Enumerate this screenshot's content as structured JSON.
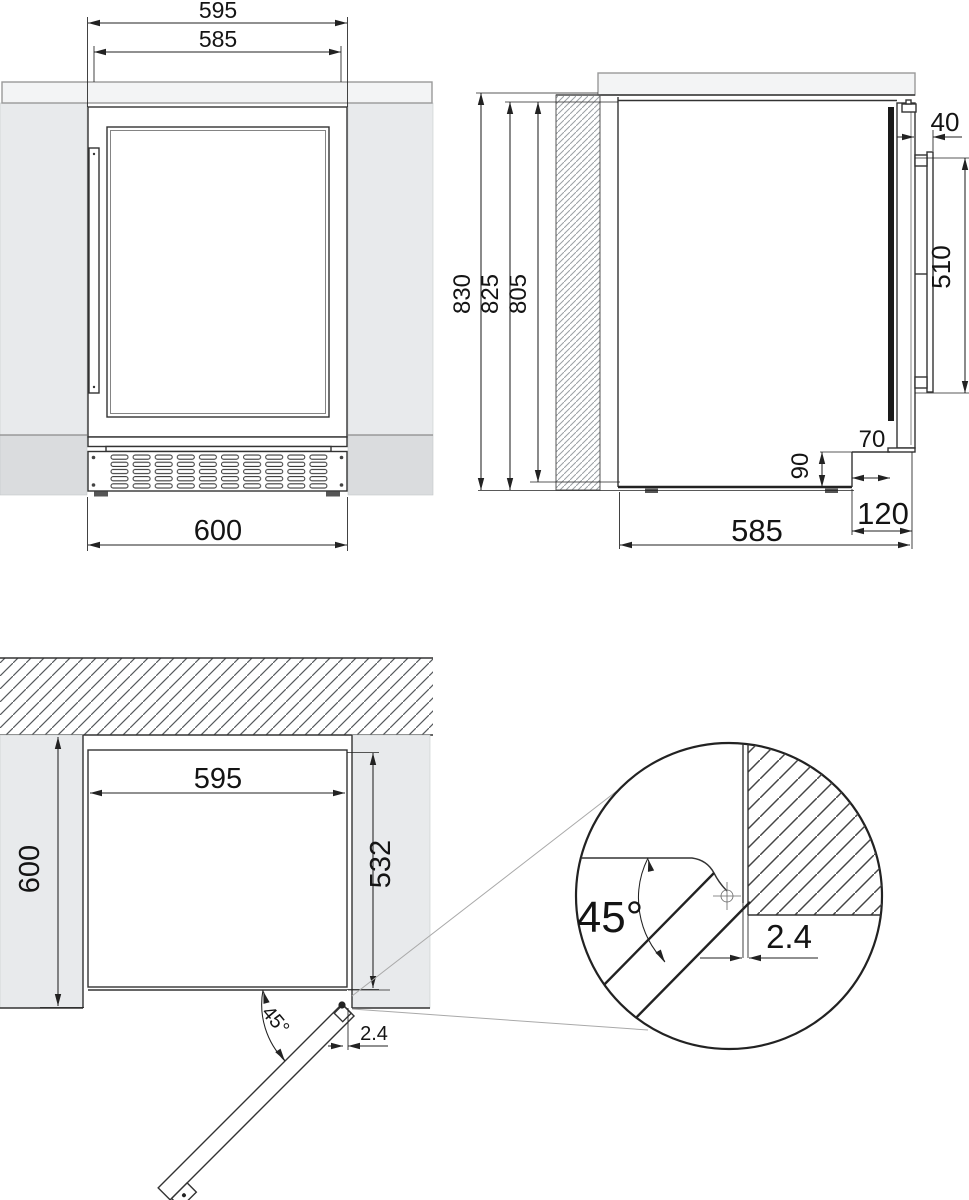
{
  "front_view": {
    "niche_width": "595",
    "appliance_width": "585",
    "overall_width": "600"
  },
  "side_view": {
    "total_height": "830",
    "niche_height": "825",
    "appliance_height": "805",
    "handle_clearance": "40",
    "handle_length": "510",
    "recess_depth": "70",
    "recess_height": "90",
    "appliance_depth": "585",
    "plinth_recess": "120"
  },
  "plan_view": {
    "appliance_width": "595",
    "niche_depth": "600",
    "body_depth": "532",
    "door_open_angle": "45°",
    "wall_gap": "2.4"
  },
  "detail_view": {
    "door_open_angle": "45°",
    "wall_gap": "2.4"
  },
  "colors": {
    "line": "#333333",
    "wall_fill": "#e8eaec",
    "counter_fill": "#f3f4f5",
    "plinth_fill": "#dadcde",
    "door_seal": "#1a1a1a"
  }
}
